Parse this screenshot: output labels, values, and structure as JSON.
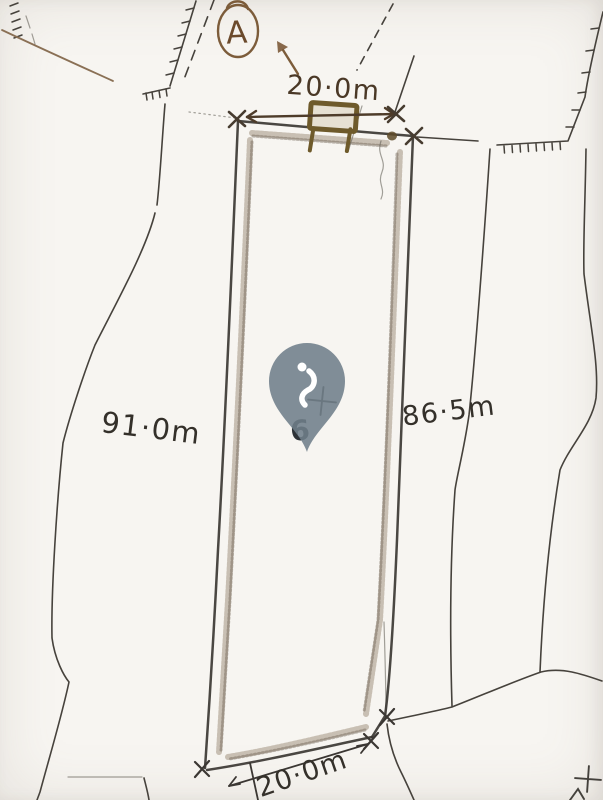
{
  "labels": {
    "top_width": "20·0m",
    "left_length": "91·0m",
    "right_length": "86·5m",
    "bottom_width": "20·0m",
    "north_marker": "A",
    "parcel_number": "6"
  },
  "colors": {
    "paper": "#f7f5f1",
    "pencil": "#3b3733",
    "sepia_ink": "#7c5c3a",
    "gate_brown": "#6e5a2b",
    "pin_fill": "#707e8a",
    "pin_glyph": "#ffffff"
  },
  "icons": {
    "north_arrow": "arrow-up-left",
    "location_pin": "map-pin-teardrop",
    "boundary_mark": "x-cross",
    "survey_point": "plus-cross"
  }
}
